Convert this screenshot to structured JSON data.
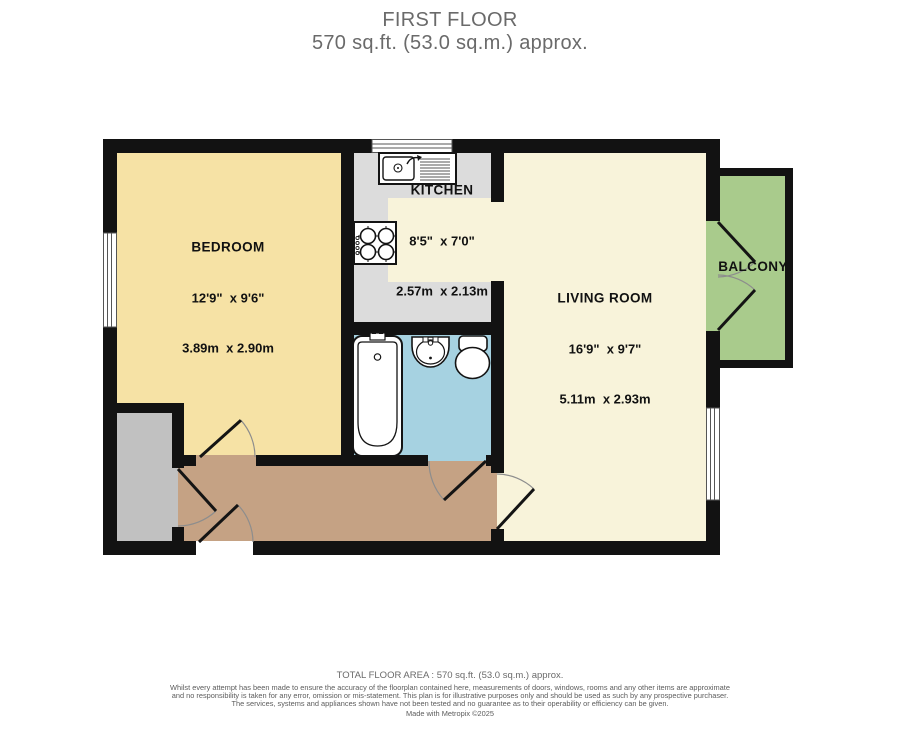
{
  "title": {
    "line1": "FIRST FLOOR",
    "line2": "570 sq.ft. (53.0 sq.m.) approx."
  },
  "rooms": {
    "bedroom": {
      "name": "BEDROOM",
      "imperial": "12'9\"  x 9'6\"",
      "metric": "3.89m  x 2.90m"
    },
    "kitchen": {
      "name": "KITCHEN",
      "imperial": "8'5\"  x 7'0\"",
      "metric": "2.57m  x 2.13m"
    },
    "living_room": {
      "name": "LIVING ROOM",
      "imperial": "16'9\"  x 9'7\"",
      "metric": "5.11m  x 2.93m"
    },
    "balcony": {
      "name": "BALCONY"
    }
  },
  "footer": {
    "total_area": "TOTAL FLOOR AREA : 570 sq.ft. (53.0 sq.m.) approx.",
    "disclaimer": "Whilst every attempt has been made to ensure the accuracy of the floorplan contained here, measurements of doors, windows, rooms and any other items are approximate and no responsibility is taken for any error, omission or mis-statement. This plan is for illustrative purposes only and should be used as such by any prospective purchaser. The services, systems and appliances shown have not been tested and no guarantee as to their operability or efficiency can be given.",
    "credit": "Made with Metropix ©2025"
  },
  "colors": {
    "wall": "#121212",
    "bedroom": "#f6e2a5",
    "kitchen_counter": "#dcdcdc",
    "floor_cream": "#f8f3da",
    "bathroom": "#a6d2e1",
    "hallway": "#c5a284",
    "store": "#c1c1c1",
    "balcony": "#a9cb8c"
  }
}
